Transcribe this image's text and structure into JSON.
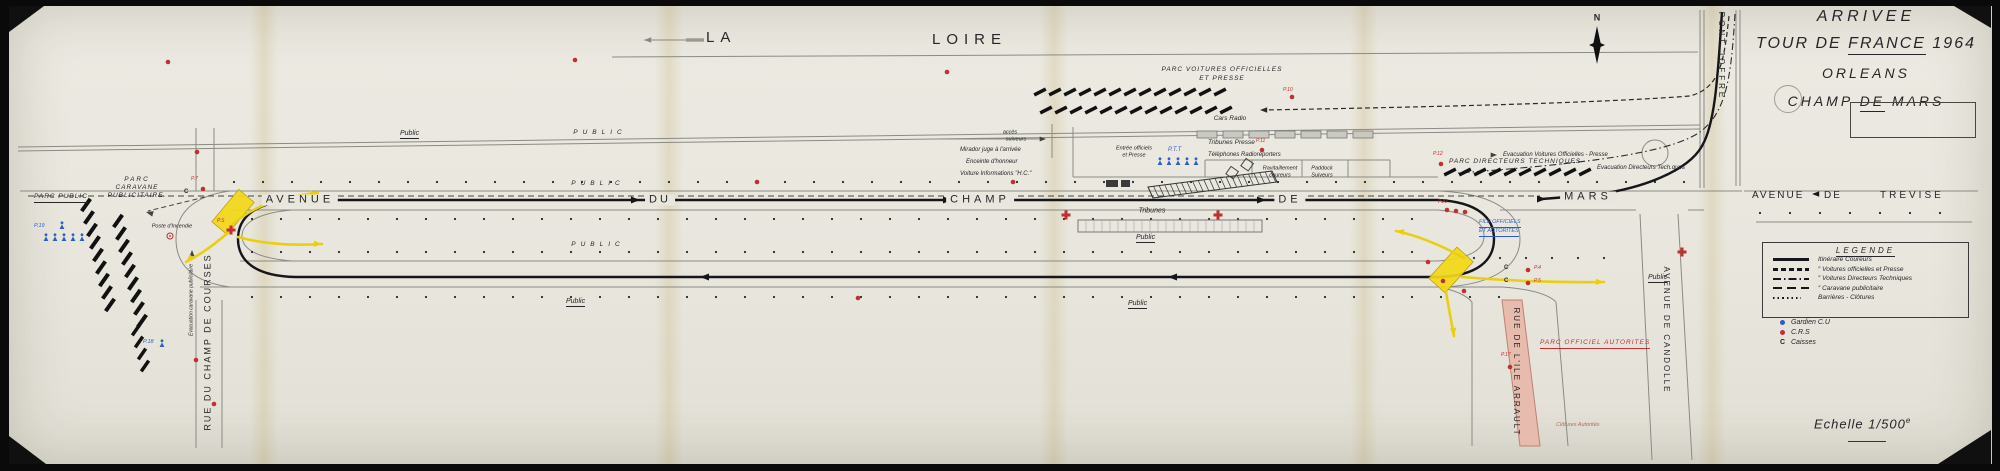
{
  "title_block": {
    "line1": "ARRIVEE",
    "line2_pre": "TOUR DE",
    "line2_underlined": "FRANCE",
    "line2_post": "1964",
    "line3": "ORLEANS",
    "line4_pre": "CHAMP",
    "line4_underlined": "DE",
    "line4_post": "MARS"
  },
  "scale": {
    "label": "Echelle",
    "value": "1/500",
    "sup": "e"
  },
  "legend": {
    "title": "LEGENDE",
    "rows": [
      {
        "style": "solid",
        "label": "Itinéraire Coureurs"
      },
      {
        "style": "dashed",
        "label": "″   Voitures officielles et Presse"
      },
      {
        "style": "dashdot",
        "label": "″   Voitures Directeurs Techniques"
      },
      {
        "style": "longdash",
        "label": "″   Caravane publicitaire"
      },
      {
        "style": "dotted",
        "label": "Barrières - Clôtures"
      }
    ],
    "markers": [
      {
        "color": "#2b5fc7",
        "label": "Gardien C.U"
      },
      {
        "color": "#c03030",
        "label": "C.R.S"
      },
      {
        "symbol": "C",
        "label": "Caisses"
      }
    ]
  },
  "colors": {
    "red": "#c03030",
    "blue": "#2b5fc7",
    "yellow": "#f2d816",
    "pink": "#e7bcae",
    "ink": "#16161a"
  },
  "map_labels": [
    {
      "n": "la-loire-la",
      "t": "LA",
      "x": 706,
      "y": 30,
      "fs": 15,
      "ls": 6
    },
    {
      "n": "la-loire-loire",
      "t": "LOIRE",
      "x": 932,
      "y": 32,
      "fs": 15,
      "ls": 6
    },
    {
      "n": "parc-voitures-officielles-1",
      "t": "PARC VOITURES OFFICIELLES",
      "x": 1222,
      "y": 70,
      "fs": 6.5,
      "ls": 1,
      "it": 1,
      "an": "c"
    },
    {
      "n": "parc-voitures-officielles-2",
      "t": "ET PRESSE",
      "x": 1222,
      "y": 79,
      "fs": 6.5,
      "ls": 1,
      "it": 1,
      "an": "c"
    },
    {
      "n": "cars-radio",
      "t": "Cars Radio",
      "x": 1230,
      "y": 119,
      "fs": 6.5,
      "it": 1,
      "an": "c"
    },
    {
      "n": "acces-suiveurs-1",
      "t": "accès",
      "x": 1010,
      "y": 133,
      "fs": 5.5,
      "it": 1,
      "an": "c"
    },
    {
      "n": "acces-suiveurs-2",
      "t": "suiveurs",
      "x": 1016,
      "y": 140,
      "fs": 5.5,
      "it": 1,
      "an": "c"
    },
    {
      "n": "mirador-juge",
      "t": "Mirador juge à l'arrivée",
      "x": 960,
      "y": 147,
      "fs": 6,
      "it": 1
    },
    {
      "n": "enceinte-honneur",
      "t": "Enceinte d'honneur",
      "x": 966,
      "y": 159,
      "fs": 6,
      "it": 1
    },
    {
      "n": "voiture-informations",
      "t": "Voiture Informations \"H.C.\"",
      "x": 960,
      "y": 171,
      "fs": 6,
      "it": 1
    },
    {
      "n": "entree-officiels-1",
      "t": "Entrée officiels",
      "x": 1134,
      "y": 149,
      "fs": 5.5,
      "it": 1,
      "an": "c"
    },
    {
      "n": "entree-officiels-2",
      "t": "et Presse",
      "x": 1134,
      "y": 156,
      "fs": 5.5,
      "it": 1,
      "an": "c"
    },
    {
      "n": "ptt",
      "t": "P.T.T",
      "x": 1168,
      "y": 147,
      "fs": 6,
      "it": 1,
      "c": "#2b5fc7"
    },
    {
      "n": "tribunes-presse",
      "t": "Tribunes Presse",
      "x": 1208,
      "y": 140,
      "fs": 6.5,
      "it": 1
    },
    {
      "n": "p11",
      "t": "P.11",
      "x": 1256,
      "y": 139,
      "fs": 5,
      "it": 1,
      "c": "#c03030"
    },
    {
      "n": "telephones-radioreporters",
      "t": "Téléphones Radioreporters",
      "x": 1208,
      "y": 152,
      "fs": 6,
      "it": 1
    },
    {
      "n": "ravitaillement-1",
      "t": "Ravitaillement",
      "x": 1280,
      "y": 169,
      "fs": 5.5,
      "it": 1,
      "an": "c"
    },
    {
      "n": "ravitaillement-2",
      "t": "coureurs",
      "x": 1280,
      "y": 176,
      "fs": 5.5,
      "it": 1,
      "an": "c"
    },
    {
      "n": "paddock-1",
      "t": "Paddock",
      "x": 1322,
      "y": 169,
      "fs": 5.5,
      "it": 1,
      "an": "c"
    },
    {
      "n": "paddock-2",
      "t": "Suiveurs",
      "x": 1322,
      "y": 176,
      "fs": 5.5,
      "it": 1,
      "an": "c"
    },
    {
      "n": "tribunes",
      "t": "Tribunes",
      "x": 1152,
      "y": 211,
      "fs": 7,
      "it": 1,
      "an": "c"
    },
    {
      "n": "parc-directeurs-techniques",
      "t": "PARC DIRECTEURS TECHNIQUES",
      "x": 1449,
      "y": 159,
      "fs": 6.5,
      "ls": 1,
      "it": 1
    },
    {
      "n": "evacuation-voitures",
      "t": "Evacuation Voitures Officielles - Presse",
      "x": 1503,
      "y": 152,
      "fs": 6,
      "it": 1
    },
    {
      "n": "evacuation-directeurs",
      "t": "Evacuation Directeurs Tech.ques",
      "x": 1597,
      "y": 165,
      "fs": 6,
      "it": 1
    },
    {
      "n": "p12",
      "t": "P.12",
      "x": 1433,
      "y": 152,
      "fs": 5,
      "it": 1,
      "c": "#c03030"
    },
    {
      "n": "avenue",
      "t": "AVENUE",
      "x": 300,
      "y": 200,
      "fs": 11,
      "ls": 4,
      "an": "c",
      "b": 1
    },
    {
      "n": "avenue-du",
      "t": "DU",
      "x": 660,
      "y": 200,
      "fs": 11,
      "ls": 3,
      "an": "c",
      "b": 1
    },
    {
      "n": "avenue-champ",
      "t": "CHAMP",
      "x": 980,
      "y": 200,
      "fs": 11,
      "ls": 4,
      "an": "c",
      "b": 1
    },
    {
      "n": "avenue-de",
      "t": "DE",
      "x": 1290,
      "y": 200,
      "fs": 11,
      "ls": 4,
      "an": "c",
      "b": 1
    },
    {
      "n": "avenue-mars",
      "t": "MARS",
      "x": 1588,
      "y": 197,
      "fs": 11,
      "ls": 4,
      "an": "c",
      "b": 1
    },
    {
      "n": "trevise-avenue",
      "t": "AVENUE",
      "x": 1752,
      "y": 191,
      "fs": 10,
      "ls": 2
    },
    {
      "n": "trevise-de",
      "t": "DE",
      "x": 1824,
      "y": 191,
      "fs": 10,
      "ls": 2
    },
    {
      "n": "trevise-trevise",
      "t": "TREVISE",
      "x": 1880,
      "y": 191,
      "fs": 10,
      "ls": 3
    },
    {
      "n": "avenue-de-candolle",
      "t": "AVENUE DE CANDOLLE",
      "x": 1666,
      "y": 330,
      "fs": 8,
      "ls": 2,
      "an": "c",
      "rot": 90
    },
    {
      "n": "pont-joffre",
      "t": "PONT JOFFRE",
      "x": 1721,
      "y": 56,
      "fs": 8,
      "ls": 3,
      "an": "c",
      "rot": 90
    },
    {
      "n": "rue-de-lile-arrault",
      "t": "RUE DE L'ILE ARRAULT",
      "x": 1516,
      "y": 372,
      "fs": 8,
      "ls": 2,
      "an": "c",
      "rot": 90
    },
    {
      "n": "rue-du-champ-de-courses",
      "t": "RUE DU CHAMP DE COURSES",
      "x": 208,
      "y": 342,
      "fs": 9,
      "ls": 2,
      "an": "c",
      "rot": -90
    },
    {
      "n": "evacuation-caravane",
      "t": "Evacuation caravane publicitaire",
      "x": 192,
      "y": 300,
      "fs": 5,
      "an": "c",
      "rot": -90,
      "it": 1
    },
    {
      "n": "parc-public",
      "t": "PARC PUBLIC",
      "x": 34,
      "y": 194,
      "fs": 6.5,
      "ls": 1,
      "it": 1,
      "ul": 1
    },
    {
      "n": "parc-caravane-1",
      "t": "PARC",
      "x": 137,
      "y": 180,
      "fs": 6.5,
      "ls": 2,
      "it": 1,
      "an": "c"
    },
    {
      "n": "parc-caravane-2",
      "t": "CARAVANE",
      "x": 137,
      "y": 188,
      "fs": 6.5,
      "ls": 1,
      "it": 1,
      "an": "c"
    },
    {
      "n": "parc-caravane-3",
      "t": "PUBLICITAIRE.",
      "x": 137,
      "y": 196,
      "fs": 6.5,
      "ls": 1,
      "it": 1,
      "an": "c"
    },
    {
      "n": "poste-incendie",
      "t": "Poste d'Incendie",
      "x": 172,
      "y": 227,
      "fs": 5.5,
      "it": 1,
      "an": "c"
    },
    {
      "n": "p7",
      "t": "P.7",
      "x": 191,
      "y": 177,
      "fs": 5,
      "it": 1,
      "c": "#c03030"
    },
    {
      "n": "p19",
      "t": "P.19",
      "x": 34,
      "y": 224,
      "fs": 5.5,
      "it": 1,
      "c": "#2b5fc7"
    },
    {
      "n": "p18",
      "t": "P.18",
      "x": 143,
      "y": 340,
      "fs": 5.5,
      "it": 1,
      "c": "#2b5fc7"
    },
    {
      "n": "p22",
      "t": "P.22",
      "x": 1438,
      "y": 200,
      "fs": 5,
      "it": 1,
      "c": "#c03030"
    },
    {
      "n": "p17",
      "t": "P.17",
      "x": 1501,
      "y": 353,
      "fs": 5,
      "it": 1,
      "c": "#c03030"
    },
    {
      "n": "p10",
      "t": "P.10",
      "x": 1283,
      "y": 88,
      "fs": 5,
      "it": 1,
      "c": "#c03030"
    },
    {
      "n": "ps",
      "t": "P.S",
      "x": 217,
      "y": 219,
      "fs": 5,
      "it": 1,
      "c": "#c03030"
    },
    {
      "n": "parc-officiel-autorites",
      "t": "PARC OFFICIEL AUTORITES",
      "x": 1540,
      "y": 340,
      "fs": 6.5,
      "ls": 1,
      "it": 1,
      "ul": 1,
      "c": "#c03030"
    },
    {
      "n": "file-officiels-1",
      "t": "FILE OFFICIELS",
      "x": 1479,
      "y": 220,
      "fs": 5.5,
      "it": 1,
      "ul": 1,
      "c": "#2b5fc7"
    },
    {
      "n": "file-officiels-2",
      "t": "ET AUTORITES",
      "x": 1479,
      "y": 229,
      "fs": 5.5,
      "it": 1,
      "ul": 1,
      "c": "#2b5fc7"
    },
    {
      "n": "caisse-c-1",
      "t": "C",
      "x": 1504,
      "y": 265,
      "fs": 6,
      "w": 1
    },
    {
      "n": "caisse-c-2",
      "t": "C",
      "x": 1504,
      "y": 278,
      "fs": 6,
      "w": 1
    },
    {
      "n": "p4",
      "t": "P.4",
      "x": 1534,
      "y": 266,
      "fs": 5,
      "it": 1,
      "c": "#c03030"
    },
    {
      "n": "p5",
      "t": "P.5",
      "x": 1534,
      "y": 279,
      "fs": 5,
      "it": 1,
      "c": "#c03030"
    },
    {
      "n": "caisse-c-3",
      "t": "C",
      "x": 184,
      "y": 189,
      "fs": 6,
      "w": 1
    },
    {
      "n": "clotures-autorites",
      "t": "Clôtures Autorités",
      "x": 1556,
      "y": 423,
      "fs": 5.5,
      "it": 1,
      "c": "#b06a5a"
    },
    {
      "n": "public-quai",
      "t": "Public",
      "x": 400,
      "y": 130,
      "fs": 7,
      "it": 1,
      "ul": 1
    },
    {
      "n": "public-quai-2",
      "t": "PUBLIC",
      "x": 600,
      "y": 133,
      "fs": 6.5,
      "ls": 5,
      "it": 1,
      "an": "c"
    },
    {
      "n": "public-nord",
      "t": "PUBLIC",
      "x": 598,
      "y": 184,
      "fs": 6.5,
      "ls": 5,
      "it": 1,
      "an": "c"
    },
    {
      "n": "public-median-est",
      "t": "Public",
      "x": 1136,
      "y": 234,
      "fs": 7,
      "it": 1,
      "ul": 1
    },
    {
      "n": "public-median",
      "t": "PUBLIC",
      "x": 598,
      "y": 245,
      "fs": 6.5,
      "ls": 5,
      "it": 1,
      "an": "c"
    },
    {
      "n": "public-sud",
      "t": "Public",
      "x": 566,
      "y": 298,
      "fs": 7,
      "it": 1,
      "ul": 1
    },
    {
      "n": "public-sud-est",
      "t": "Public",
      "x": 1128,
      "y": 300,
      "fs": 7,
      "it": 1,
      "ul": 1
    },
    {
      "n": "public-candolle",
      "t": "Public",
      "x": 1648,
      "y": 274,
      "fs": 7,
      "it": 1,
      "ul": 1
    },
    {
      "n": "compass-n",
      "t": "N",
      "x": 1597,
      "y": 18,
      "fs": 9,
      "w": 1,
      "an": "c"
    }
  ],
  "symbols": {
    "red_dots": [
      [
        168,
        62
      ],
      [
        575,
        60
      ],
      [
        947,
        72
      ],
      [
        1292,
        97
      ],
      [
        197,
        152
      ],
      [
        203,
        189
      ],
      [
        1262,
        150
      ],
      [
        1441,
        164
      ],
      [
        1447,
        210
      ],
      [
        1456,
        211
      ],
      [
        1465,
        212
      ],
      [
        1428,
        262
      ],
      [
        1443,
        281
      ],
      [
        1464,
        291
      ],
      [
        1528,
        270
      ],
      [
        1528,
        283
      ],
      [
        1510,
        367
      ],
      [
        196,
        360
      ],
      [
        214,
        404
      ],
      [
        757,
        182
      ],
      [
        1013,
        182
      ],
      [
        858,
        298
      ]
    ],
    "red_crosses": [
      [
        231,
        230
      ],
      [
        1066,
        215
      ],
      [
        1218,
        215
      ],
      [
        1682,
        252
      ]
    ],
    "blue_figures": [
      [
        62,
        226
      ],
      [
        46,
        238
      ],
      [
        55,
        238
      ],
      [
        64,
        238
      ],
      [
        73,
        238
      ],
      [
        82,
        238
      ],
      [
        162,
        344
      ],
      [
        1160,
        162
      ],
      [
        1169,
        162
      ],
      [
        1178,
        162
      ],
      [
        1187,
        162
      ],
      [
        1196,
        162
      ]
    ]
  }
}
